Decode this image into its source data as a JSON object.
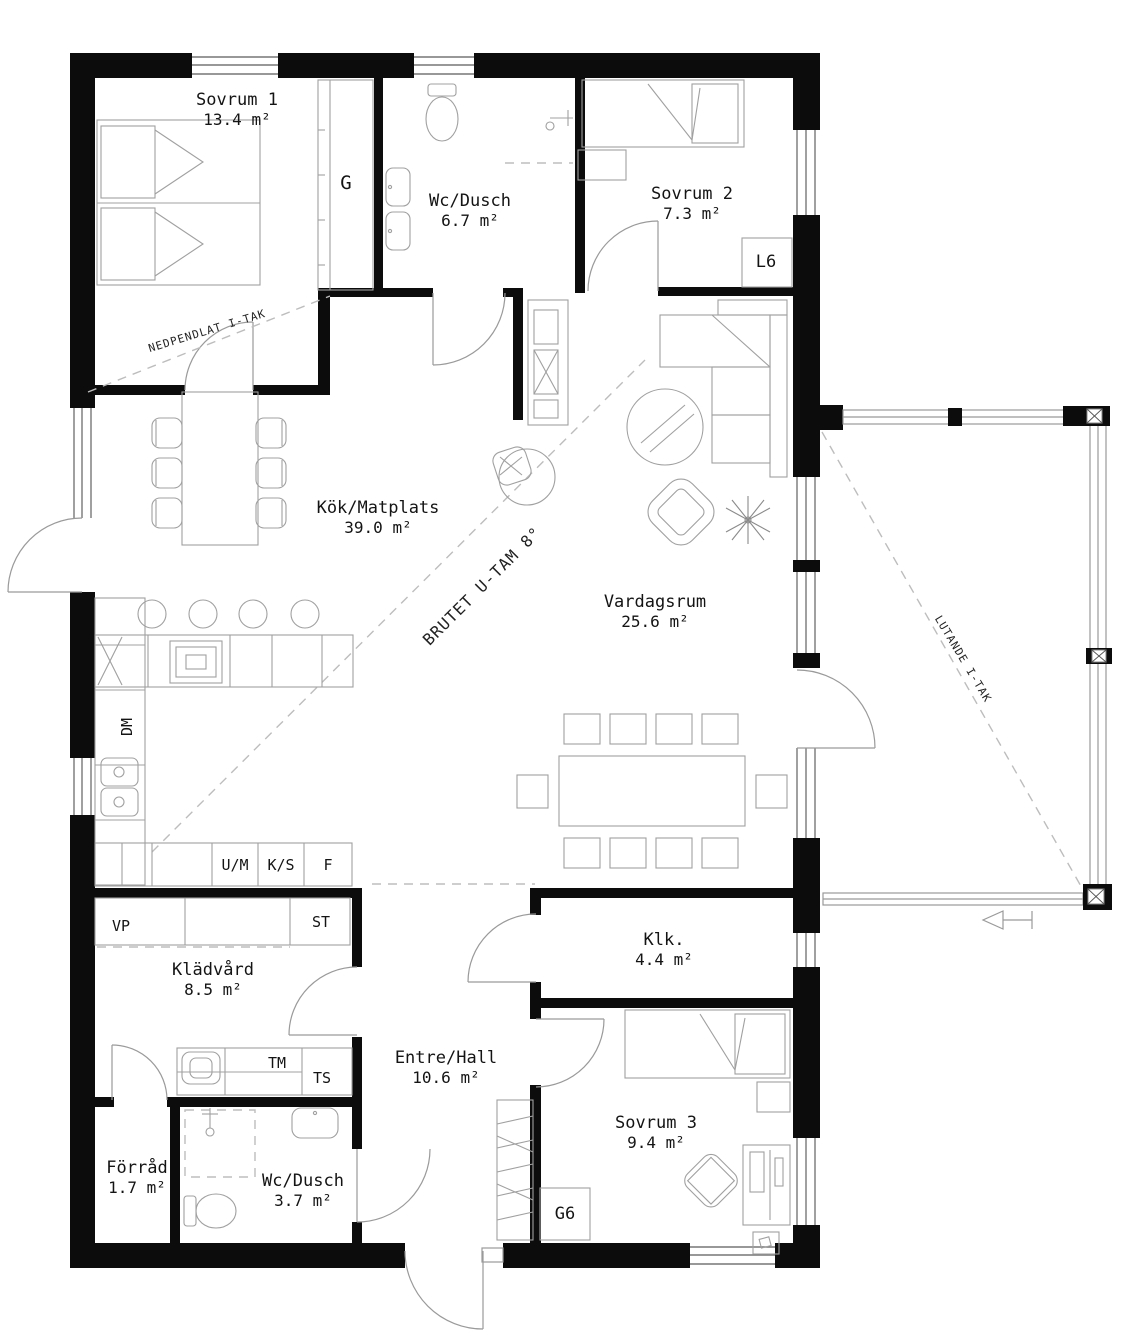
{
  "rooms": {
    "sovrum_1": {
      "name": "Sovrum 1",
      "area": "13.4 m²"
    },
    "wc_dusch_ovre": {
      "name": "Wc/Dusch",
      "area": "6.7 m²"
    },
    "sovrum_2": {
      "name": "Sovrum 2",
      "area": "7.3 m²"
    },
    "kok_matplats": {
      "name": "Kök/Matplats",
      "area": "39.0 m²"
    },
    "vardagsrum": {
      "name": "Vardagsrum",
      "area": "25.6 m²"
    },
    "kladvard": {
      "name": "Klädvård",
      "area": "8.5 m²"
    },
    "entre_hall": {
      "name": "Entre/Hall",
      "area": "10.6 m²"
    },
    "klk": {
      "name": "Klk.",
      "area": "4.4 m²"
    },
    "forrad": {
      "name": "Förråd",
      "area": "1.7 m²"
    },
    "wc_dusch_nedre": {
      "name": "Wc/Dusch",
      "area": "3.7 m²"
    },
    "sovrum_3": {
      "name": "Sovrum 3",
      "area": "9.4 m²"
    }
  },
  "closets": {
    "g": "G",
    "l6": "L6",
    "g6": "G6"
  },
  "appliances": {
    "dm": "DM",
    "um": "U/M",
    "ks": "K/S",
    "f": "F",
    "vp": "VP",
    "st": "ST",
    "tm": "TM",
    "ts": "TS"
  },
  "ceiling_notes": {
    "nedpendlat": "NEDPENDLAT I-TAK",
    "brutet": "BRUTET U-TAM 8°",
    "lutande": "LUTANDE I-TAK"
  },
  "colors": {
    "wall": "#0c0c0c",
    "line": "#a0a0a0",
    "dash": "#bdbdbd",
    "text": "#141414"
  }
}
